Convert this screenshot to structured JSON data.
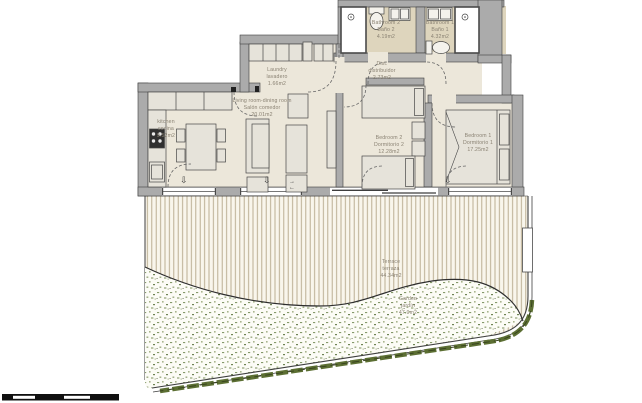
{
  "title": "Apartment floor plan with terrace and garden",
  "rooms": [
    {
      "id": "kitchen",
      "name_en": "kitchen",
      "name_es": "cocina",
      "area": "9.52m2"
    },
    {
      "id": "living",
      "name_en": "Living room-dining room",
      "name_es": "Salón comedor",
      "area": "20.01m2"
    },
    {
      "id": "laundry",
      "name_en": "Laundry",
      "name_es": "lavadero",
      "area": "1.66m2"
    },
    {
      "id": "hall",
      "name_en": "Dist.",
      "name_es": "distribuidor",
      "area": "2.73m2"
    },
    {
      "id": "bathroom2",
      "name_en": "Bathroom 2",
      "name_es": "Baño 2",
      "area": "4.19m2"
    },
    {
      "id": "bathroom1",
      "name_en": "Bathroom 1",
      "name_es": "Baño 1",
      "area": "4.32m2"
    },
    {
      "id": "bedroom2",
      "name_en": "Bedroom 2",
      "name_es": "Dormitorio 2",
      "area": "12.28m2"
    },
    {
      "id": "bedroom1",
      "name_en": "Bedroom 1",
      "name_es": "Dormitorio 1",
      "area": "17.25m2"
    },
    {
      "id": "terrace",
      "name_en": "Terrace",
      "name_es": "terraza",
      "area": "44.34m2"
    },
    {
      "id": "garden",
      "name_en": "Garden",
      "name_es": "jardín",
      "area": "47.9m2"
    }
  ],
  "symbols": {
    "exit_arrow": "⇩",
    "arrow_right": "→",
    "arrow_left": "←"
  },
  "colors": {
    "wall": "#ababab",
    "floor": "#ece7da",
    "bathroom_floor": "#ded5bd",
    "furniture": "#e6e3da",
    "deck_line": "#b4a689",
    "garden_green": "#7d915c",
    "boundary_green": "#5c6f33",
    "label_text": "#8a8273",
    "scale_bar": "#101010"
  }
}
